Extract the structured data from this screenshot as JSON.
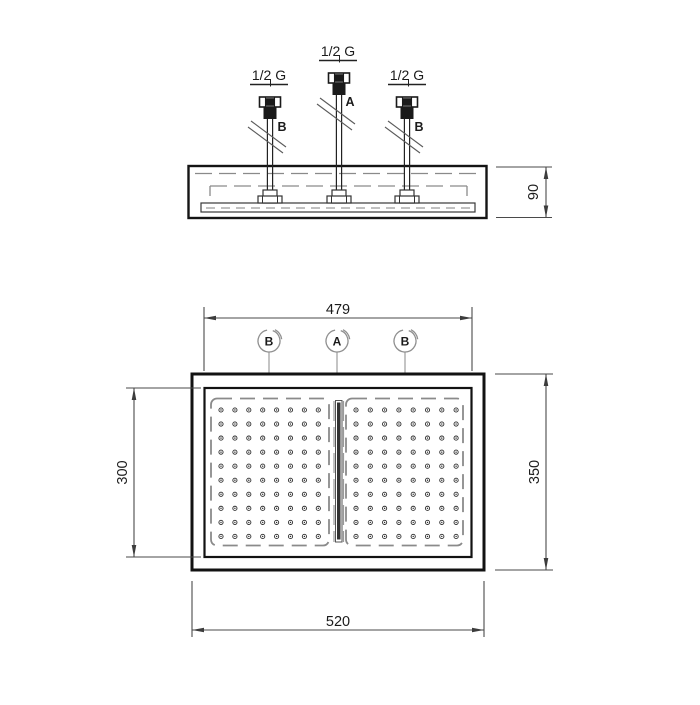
{
  "colors": {
    "background": "#ffffff",
    "outline": "#161616",
    "dashed": "#8a8a8a",
    "dimension_line": "#3c3c3c",
    "text": "#1b1b1b"
  },
  "side_view": {
    "connections": [
      {
        "thread_label": "1/2 G",
        "port": "B"
      },
      {
        "thread_label": "1/2 G",
        "port": "A"
      },
      {
        "thread_label": "1/2 G",
        "port": "B"
      }
    ],
    "dims": {
      "depth": "90"
    }
  },
  "plan_view": {
    "balloons": [
      {
        "label": "B"
      },
      {
        "label": "A"
      },
      {
        "label": "B"
      }
    ],
    "dims": {
      "face_width": "479",
      "face_height": "300",
      "body_height": "350",
      "body_width": "520"
    },
    "nozzle_grid": {
      "panels": 2,
      "cols": 8,
      "rows": 10
    }
  }
}
